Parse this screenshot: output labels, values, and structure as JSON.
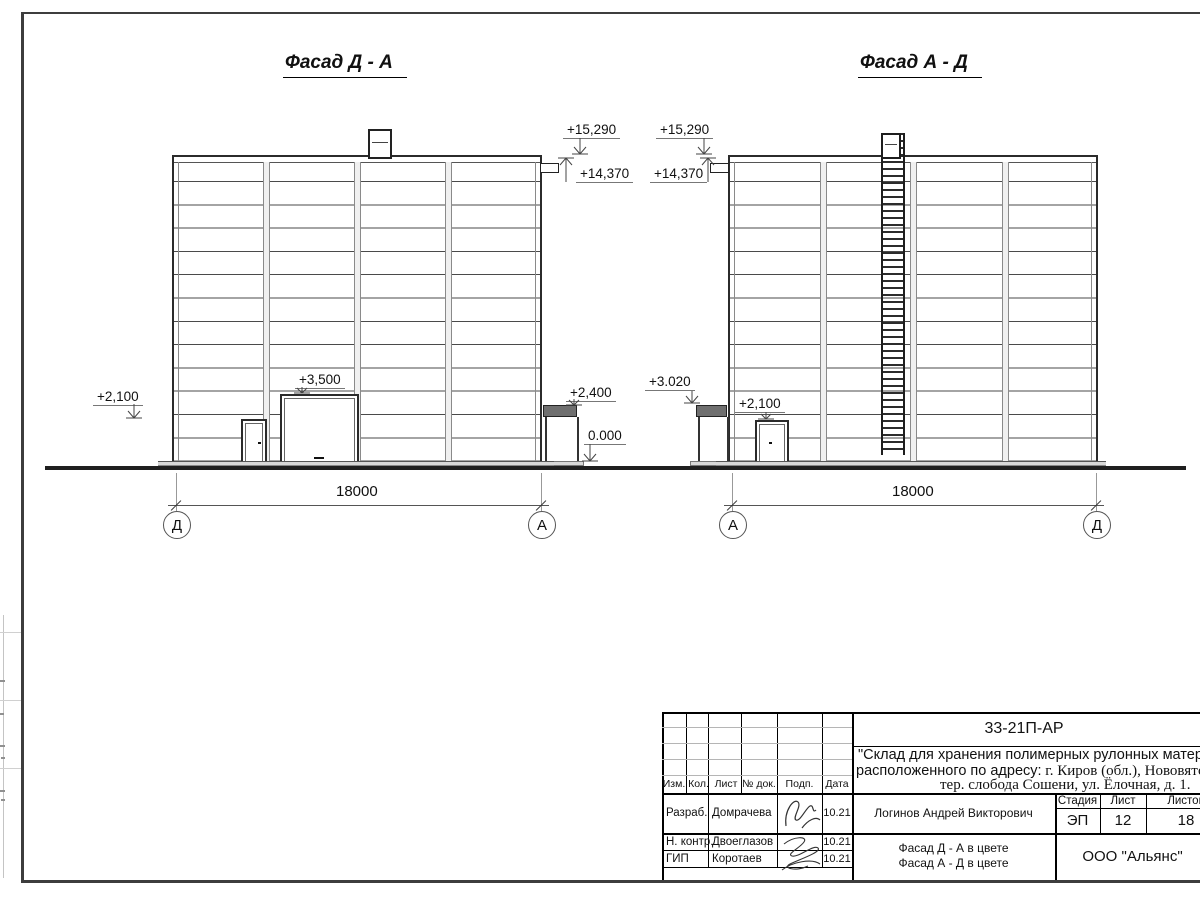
{
  "facades": [
    {
      "title": "Фасад Д - А",
      "dimension": "18000",
      "axis_left": "Д",
      "axis_right": "А",
      "marks": {
        "m15290": "+15,290",
        "m14370": "+14,370",
        "m2100": "+2,100",
        "m3500": "+3,500",
        "m2400": "+2,400",
        "m0": "0.000"
      }
    },
    {
      "title": "Фасад А - Д",
      "dimension": "18000",
      "axis_left": "А",
      "axis_right": "Д",
      "marks": {
        "m15290": "+15,290",
        "m14370": "+14,370",
        "m3020": "+3.020",
        "m2100": "+2,100"
      }
    }
  ],
  "title_block": {
    "doc_number": "33-21П-АР",
    "project_line1": "\"Склад для хранения полимерных рулонных материалов\",",
    "project_line2_sans": "расположенного по адресу:",
    "project_line2_serif": " г. Киров (обл.), Нововятский р-он,",
    "project_line3": "тер. слобода Сошени, ул. Ёлочная, д. 1.",
    "columns": [
      "Изм.",
      "Кол.",
      "Лист",
      "№ док.",
      "Подп.",
      "Дата"
    ],
    "rows": [
      {
        "role": "Разраб.",
        "name": "Домрачева",
        "date": "10.21"
      },
      {
        "role": "Н. контр.",
        "name": "Двоеглазов",
        "date": "10.21"
      },
      {
        "role": "ГИП",
        "name": "Коротаев",
        "date": "10.21"
      }
    ],
    "supervisor": "Логинов Андрей Викторович",
    "stage_header": [
      "Стадия",
      "Лист",
      "Листов"
    ],
    "stage": "ЭП",
    "sheet_number": "12",
    "sheet_total": "18",
    "sheet_title_line1": "Фасад Д - А в цвете",
    "sheet_title_line2": "Фасад А - Д в цвете",
    "company": "ООО \"Альянс\""
  }
}
